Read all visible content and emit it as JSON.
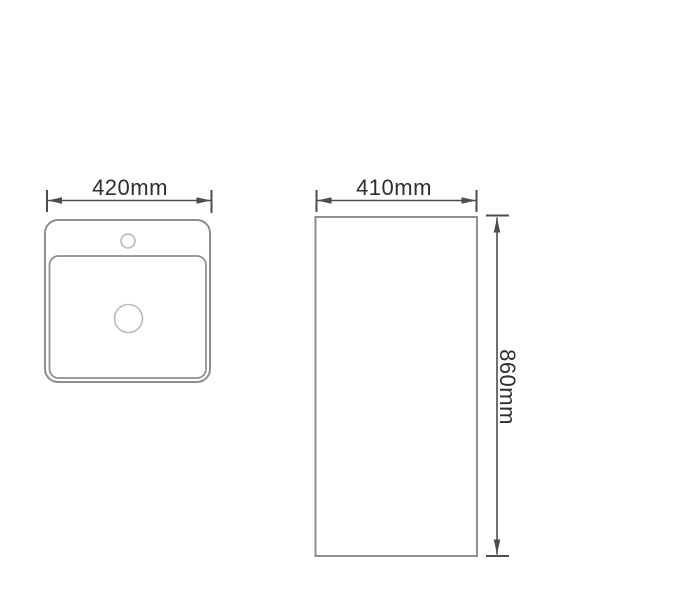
{
  "page": {
    "background": "#ffffff"
  },
  "diagram": {
    "type": "technical-drawing",
    "subject": "pedestal-basin-dimension-diagram",
    "colors": {
      "outline": "#8c8e90",
      "light_outline": "#b7b9bb",
      "dimension": "#4d4d4d",
      "text": "#2e2e2e",
      "fill": "#ffffff"
    },
    "top_view": {
      "width_label": "420mm"
    },
    "front_view": {
      "width_label": "410mm",
      "height_label": "860mm"
    }
  }
}
